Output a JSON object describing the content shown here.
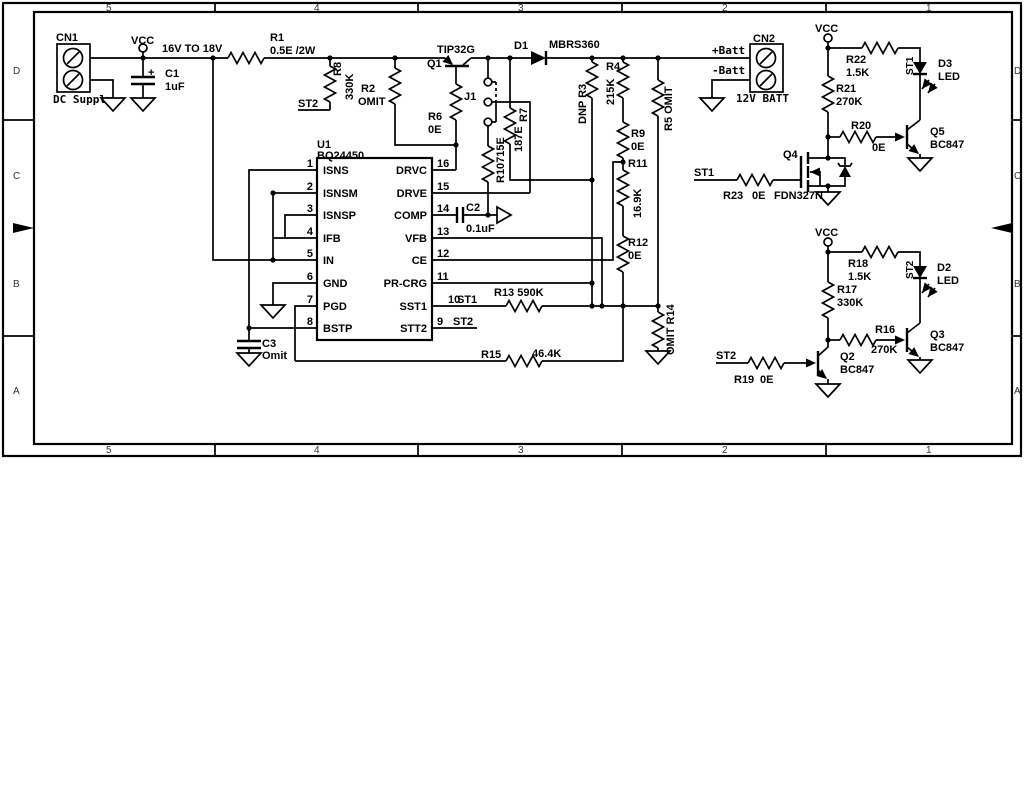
{
  "zones": {
    "cols": [
      "5",
      "4",
      "3",
      "2",
      "1"
    ],
    "rows": [
      "D",
      "C",
      "B",
      "A"
    ]
  },
  "t": {
    "cn1": "CN1",
    "dc_supply": "DC Supply",
    "vcc": "VCC",
    "range": "16V TO 18V",
    "c1": "C1",
    "c1v": "1uF",
    "plus": "+",
    "r1": "R1",
    "r1v": "0.5E /2W",
    "r8": "R8",
    "v330k": "330K",
    "st2": "ST2",
    "st1": "ST1",
    "r2": "R2",
    "omit": "OMIT",
    "q1": "Q1",
    "q1t": "TIP32G",
    "r6": "R6",
    "v0e": "0E",
    "j1": "J1",
    "r10": "R10715E",
    "d1": "D1",
    "d1t": "MBRS360",
    "r7": "R7",
    "r7v": "187E",
    "c2": "C2",
    "c2v": "0.1uF",
    "r3": "DNP R3",
    "r4": "R4",
    "r4v": "215K",
    "r9": "R9",
    "r11": "R11",
    "r11v": "16.9K",
    "r12": "R12",
    "r5": "R5 OMIT",
    "r14": "OMIT R14",
    "u1": "U1",
    "u1t": "BQ24450",
    "pin_names_left": [
      "ISNS",
      "ISNSM",
      "ISNSP",
      "IFB",
      "IN",
      "GND",
      "PGD",
      "BSTP"
    ],
    "pin_names_right": [
      "DRVC",
      "DRVE",
      "COMP",
      "VFB",
      "CE",
      "PR-CRG",
      "SST1",
      "STT2"
    ],
    "pin_nums_left": [
      "1",
      "2",
      "3",
      "4",
      "5",
      "6",
      "7",
      "8"
    ],
    "pin_nums_right": [
      "16",
      "15",
      "14",
      "13",
      "12",
      "11",
      "10",
      "9"
    ],
    "r13": "R13 590K",
    "r15": "R15",
    "r15v": "46.4K",
    "c3": "C3",
    "c3v": "Omit",
    "cn2": "CN2",
    "batt_p": "+Batt",
    "batt_n": "-Batt",
    "batt12": "12V BATT",
    "r22": "R22",
    "v15k": "1.5K",
    "r21": "R21",
    "v270k": "270K",
    "r20": "R20",
    "d3": "D3",
    "led": "LED",
    "q5": "Q5",
    "bc847": "BC847",
    "q4": "Q4",
    "q4t": "FDN327N",
    "r23": "R23",
    "r18": "R18",
    "r17": "R17",
    "r16": "R16",
    "d2": "D2",
    "q3": "Q3",
    "q2": "Q2",
    "r19": "R19"
  }
}
